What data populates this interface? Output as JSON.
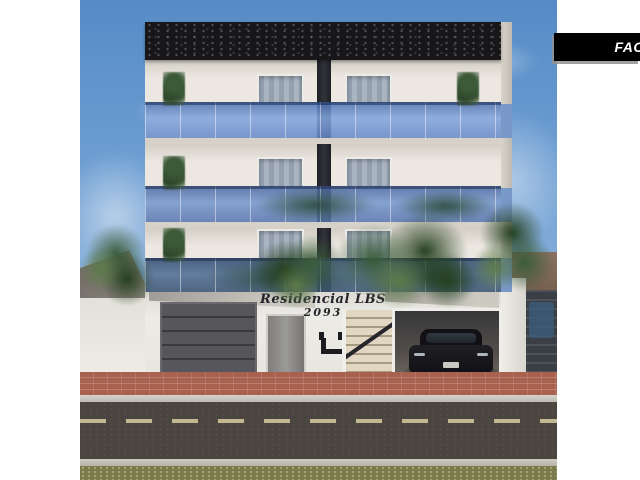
{
  "banner": {
    "label": "FAC",
    "bg": "#000000",
    "text_color": "#ffffff"
  },
  "sign": {
    "line1": "Residencial LBS",
    "line2": "2093"
  },
  "scene": {
    "description": "3D architectural rendering of a residential building facade: black textured parapet, three floors with blue glass balcony railings and curtained sliding doors, ground floor with entrance sign, stairs, sectional garage door and open garage holding a black SUV, fronted by street trees, red paver sidewalk and asphalt road with dashed lane line under a blue sky; white page margins with a black corner ribbon",
    "objects": [
      "building-facade",
      "parapet",
      "balcony-glass-railing",
      "balcony-plants",
      "curtained-windows",
      "garage-door",
      "entrance-sign",
      "entrance-stairs",
      "black-suv",
      "street-trees",
      "sidewalk-pavers",
      "road-lane-line",
      "neighbor-houses"
    ],
    "colors": {
      "page_background": "#ffffff",
      "sky_top": "#558bc6",
      "sky_bottom": "#bcd3ea",
      "parapet": "#17171a",
      "wall": "#ece8e1",
      "glass_rail": "#7aa0d8",
      "curtain": "#9fa9b5",
      "garage_door": "#4b4a4a",
      "sidewalk_pavers": "#a8604f",
      "road": "#4a453f",
      "lane_line": "#cfc49a",
      "grass": "#7b7a4d",
      "car": "#17171a",
      "foliage": "#2f4c33"
    }
  }
}
